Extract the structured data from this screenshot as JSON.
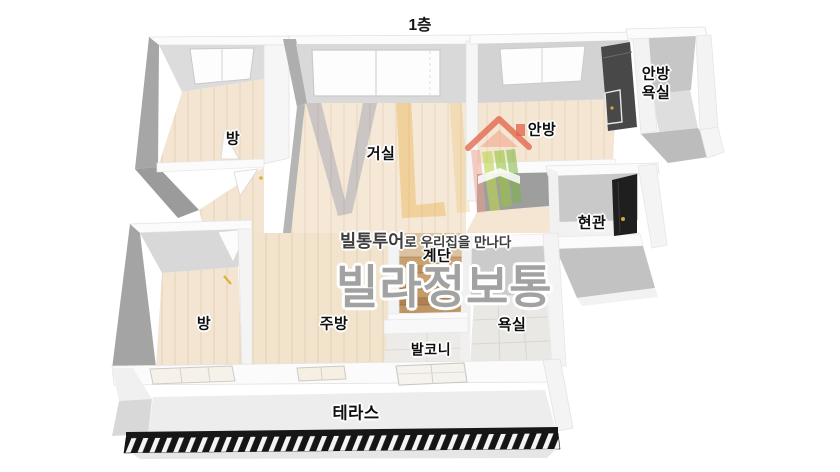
{
  "title": "1층",
  "rooms": [
    {
      "id": "room-top-left",
      "label": "방"
    },
    {
      "id": "living-room",
      "label": "거실"
    },
    {
      "id": "master-bedroom",
      "label": "안방"
    },
    {
      "id": "master-bathroom",
      "label": "안방\n욕실"
    },
    {
      "id": "entrance",
      "label": "현관"
    },
    {
      "id": "stairs",
      "label": "계단"
    },
    {
      "id": "room-bottom-left",
      "label": "방"
    },
    {
      "id": "kitchen",
      "label": "주방"
    },
    {
      "id": "balcony",
      "label": "발코니"
    },
    {
      "id": "bathroom",
      "label": "욕실"
    },
    {
      "id": "terrace",
      "label": "테라스"
    }
  ],
  "watermark": {
    "tagline_bold": "빌통투어",
    "tagline_rest": "로 우리집을 만나다",
    "brand": "빌라정보통",
    "logo": "house-logo"
  },
  "palette": {
    "floor_wood": "#f4e6d2",
    "wall_light": "#fbfbfb",
    "wall_shadow": "#a6a6a6",
    "wall_face": "#d9d9d9",
    "tile": "#eae8e4",
    "stair_wood": "#c49a6c",
    "railing_black": "#171717",
    "label_text": "#0e0e0e",
    "brand_gray": "#a2a2a2",
    "tagline_dark": "#3d3d3d",
    "logo_coral": "#e26046",
    "logo_green": "#a6cc3f",
    "handle_yellow": "#d9b23c",
    "door_black": "#1f1f1f"
  }
}
